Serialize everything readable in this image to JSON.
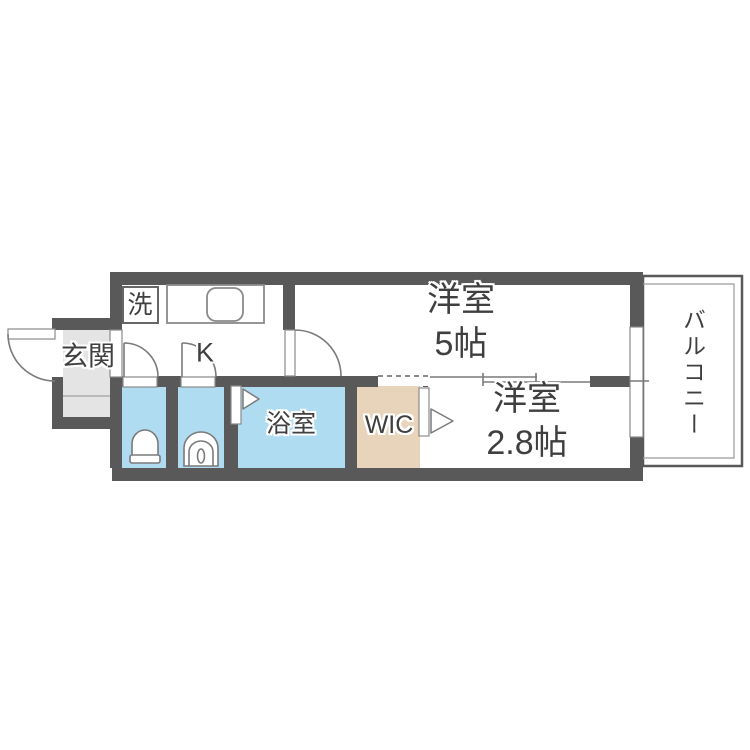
{
  "plan": {
    "type": "apartment-floor-plan",
    "labels": {
      "entrance": "玄関",
      "laundry": "洗",
      "kitchen": "K",
      "bathroom": "浴室",
      "walk_in_closet": "WIC",
      "western_room_5": {
        "name": "洋室",
        "size": "5帖"
      },
      "western_room_2_8": {
        "name": "洋室",
        "size": "2.8帖"
      },
      "balcony": "バルコニー"
    },
    "colors": {
      "wall": "#595959",
      "wet_area": "#b0dcf2",
      "closet": "#e7d4ba",
      "entrance_floor": "#e4e4e4",
      "label_text": "#3f3f3f",
      "background": "#ffffff"
    },
    "icons": {
      "toilet": "toilet-icon",
      "washbasin": "washbasin-icon",
      "kitchen_sink": "kitchen-sink-icon",
      "front_door": "door-swing-arc-icon",
      "interior_doors": "door-swing-arc-icon",
      "folding_doors": "folding-door-arrow-icon",
      "sliding_door": "sliding-door-lines-icon"
    }
  }
}
